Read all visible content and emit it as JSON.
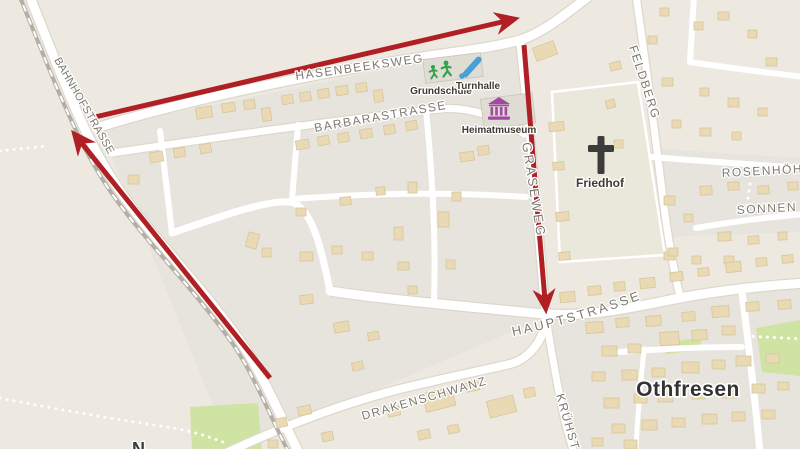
{
  "map": {
    "town": {
      "label": "Othfresen"
    },
    "streets": [
      {
        "name": "BAHNHOFSTRASSE"
      },
      {
        "name": "HASENBEEKSWEG"
      },
      {
        "name": "BARBARASTRASSE"
      },
      {
        "name": "GRASEWEG"
      },
      {
        "name": "FELDBERG"
      },
      {
        "name": "HAUPTSTRASSE"
      },
      {
        "name": "DRAKENSCHWANZ"
      },
      {
        "name": "KRÜHST"
      },
      {
        "name": "ROSENHÖH"
      },
      {
        "name": "SONNEN"
      },
      {
        "name": "N"
      }
    ],
    "pois": [
      {
        "label": "Grundschule",
        "icon": "school-children-icon",
        "icon_color": "#2fa24c"
      },
      {
        "label": "Turnhalle",
        "icon": "sports-bat-icon",
        "icon_color": "#4aa0d5"
      },
      {
        "label": "Heimatmuseum",
        "icon": "museum-icon",
        "icon_color": "#a349a3"
      },
      {
        "label": "Friedhof",
        "icon": "cross-icon",
        "icon_color": "#3c3c3c"
      }
    ],
    "route_overlay": {
      "color": "#b01f24",
      "arrow_count": 3
    },
    "palette": {
      "land": "#ede9e0",
      "block": "#e6e4dd",
      "road": "#ffffff",
      "building": "#e9dab5",
      "green": "#cfe3a2",
      "railway": "#b3afa6",
      "street_label": "#7d7970",
      "poi_label": "#3f3a33",
      "town_label": "#333333"
    }
  }
}
